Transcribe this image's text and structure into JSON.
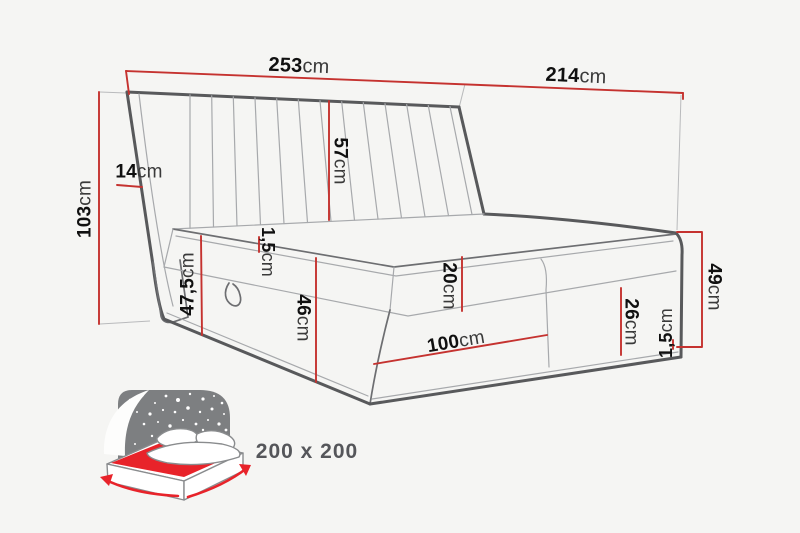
{
  "diagram": {
    "title": "boxspring-bed-dimension-drawing",
    "dims": {
      "total_width": {
        "num": "253",
        "unit": "cm"
      },
      "length": {
        "num": "214",
        "unit": "cm"
      },
      "headboard_height": {
        "num": "103",
        "unit": "cm"
      },
      "wing_width": {
        "num": "14",
        "unit": "cm"
      },
      "headboard_above_mattress": {
        "num": "57",
        "unit": "cm"
      },
      "topper_left": {
        "num": "1,5",
        "unit": "cm"
      },
      "sleep_height": {
        "num": "47,5",
        "unit": "cm"
      },
      "base_height": {
        "num": "46",
        "unit": "cm"
      },
      "mattress_height": {
        "num": "20",
        "unit": "cm"
      },
      "front_section": {
        "num": "100",
        "unit": "cm"
      },
      "foot_section": {
        "num": "26",
        "unit": "cm"
      },
      "foot_height": {
        "num": "49",
        "unit": "cm"
      },
      "topper_right": {
        "num": "1,5",
        "unit": "cm"
      }
    },
    "badge": {
      "mattress_size": "200 x 200"
    },
    "colors": {
      "dimension_red": "#c5322f",
      "outline_gray": "#58595b",
      "icon_gray": "#7d7f81",
      "icon_red": "#e8232a",
      "background": "#f5f5f3"
    }
  }
}
